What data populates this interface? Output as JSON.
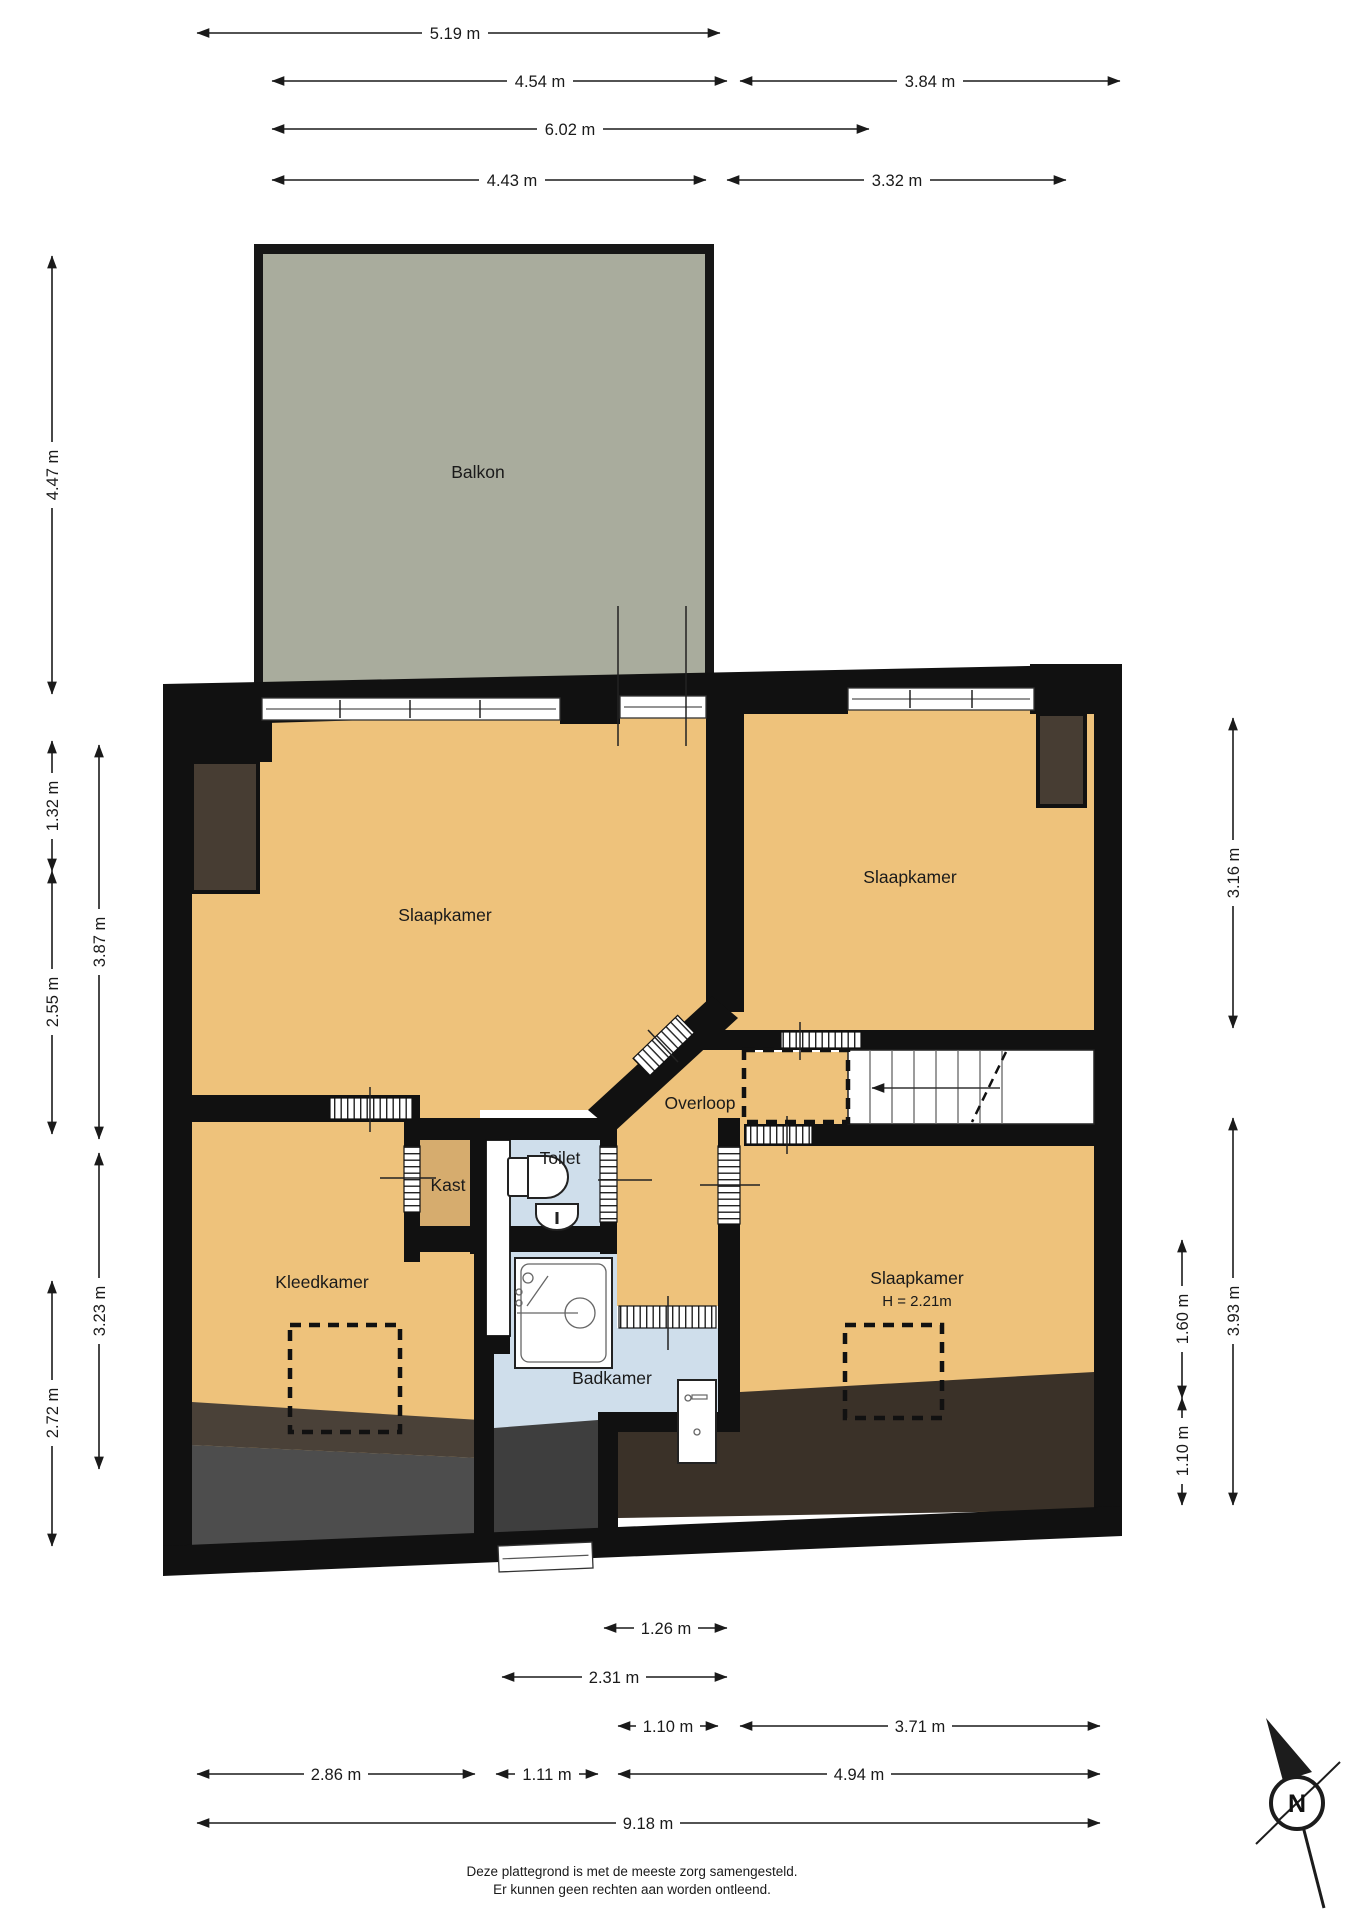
{
  "document": {
    "type": "floor-plan",
    "footer_line1": "Deze plattegrond is met de meeste zorg samengesteld.",
    "footer_line2": "Er kunnen geen rechten aan worden ontleend."
  },
  "rooms": {
    "balkon": {
      "label": "Balkon"
    },
    "slaapkamer1": {
      "label": "Slaapkamer"
    },
    "slaapkamer2": {
      "label": "Slaapkamer"
    },
    "slaapkamer3": {
      "label": "Slaapkamer",
      "height_note": "H = 2.21m"
    },
    "overloop": {
      "label": "Overloop"
    },
    "kleedkamer": {
      "label": "Kleedkamer"
    },
    "badkamer": {
      "label": "Badkamer"
    },
    "toilet": {
      "label": "Toilet"
    },
    "kast": {
      "label": "Kast"
    }
  },
  "dimensions": {
    "top": [
      "5.19 m",
      "4.54 m",
      "3.84 m",
      "6.02 m",
      "4.43 m",
      "3.32 m"
    ],
    "left": [
      "4.47 m",
      "1.32 m",
      "2.55 m",
      "2.72 m",
      "3.87 m",
      "3.23 m"
    ],
    "right": [
      "3.16 m",
      "3.93 m",
      "1.60 m",
      "1.10 m"
    ],
    "bottom": [
      "1.26 m",
      "2.31 m",
      "1.10 m",
      "3.71 m",
      "2.86 m",
      "1.11 m",
      "4.94 m",
      "9.18 m"
    ]
  },
  "compass": {
    "label": "N"
  },
  "colors": {
    "floor_orange": "#eec27b",
    "kast_tan": "#d6ac6e",
    "wet_blue": "#cfdeeb",
    "balcony_gray": "#a9ac9d",
    "closet_brown": "#473d33",
    "slope_dark_brown": "#3a3128",
    "slope_gray": "#4d4d4d",
    "wall_black": "#111111"
  }
}
